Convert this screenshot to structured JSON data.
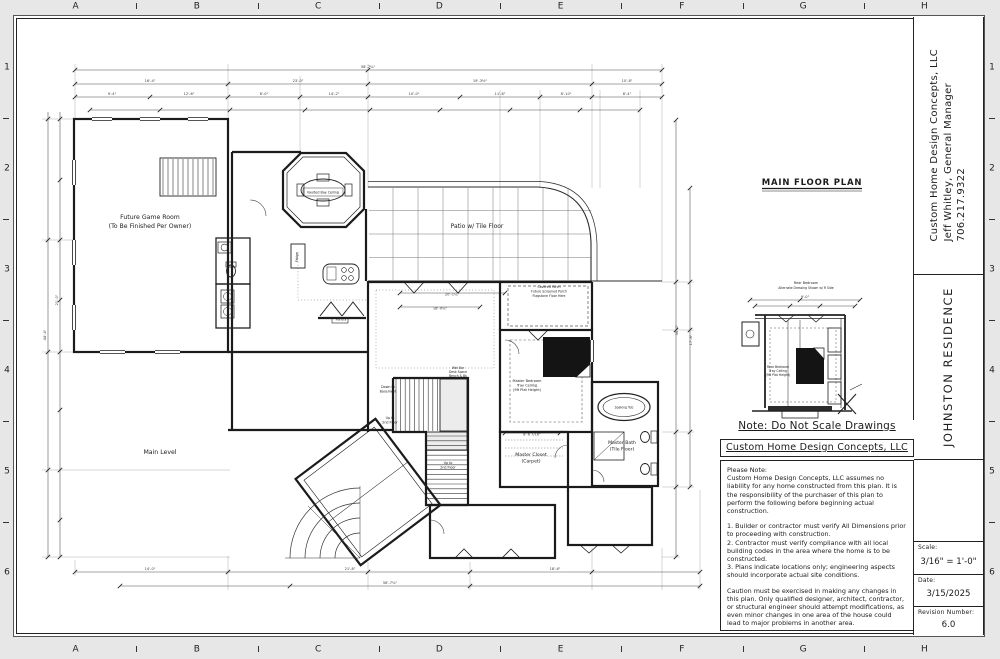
{
  "page": {
    "background": "#e7e7e7",
    "line_color": "#2b2b2b"
  },
  "sheet": {
    "grid_letters": [
      "A",
      "B",
      "C",
      "D",
      "E",
      "F",
      "G",
      "H"
    ],
    "grid_numbers": [
      "1",
      "2",
      "3",
      "4",
      "5",
      "6"
    ]
  },
  "title_block": {
    "company": "Custom Home Design Concepts, LLC",
    "manager": "Jeff Whitley, General Manager",
    "phone": "706.217.9322",
    "project": "JOHNSTON RESIDENCE",
    "scale_label": "Scale:",
    "scale_value": "3/16\" = 1'-0\"",
    "date_label": "Date:",
    "date_value": "3/15/2025",
    "revision_label": "Revision Number:",
    "revision_value": "6.0"
  },
  "notes_panel": {
    "note_header": "Note: Do Not Scale Drawings",
    "company_header": "Custom Home Design Concepts, LLC",
    "paragraphs": [
      {
        "text": "Please Note:",
        "gap": false
      },
      {
        "text": "Custom Home Design Concepts, LLC assumes no liability for any home constructed from this plan. It is the responsibility of the purchaser of this plan to perform the following before beginning actual construction.",
        "gap": false
      },
      {
        "text": "1.  Builder or contractor must verify All Dimensions prior to proceeding with construction.",
        "gap": true
      },
      {
        "text": "2.  Contractor must verify compliance with all local building codes in the area where the home is to be constructed.",
        "gap": false
      },
      {
        "text": "3.  Plans indicate locations only; engineering aspects should incorporate actual site conditions.",
        "gap": false
      },
      {
        "text": "Caution must be exercised in making any changes in this plan.  Only qualified designer, architect, contractor, or structural engineer should attempt modifications, as even minor changes in one area of the house could lead to major problems in another area.",
        "gap": true
      }
    ]
  },
  "plan": {
    "title": "MAIN FLOOR PLAN",
    "labels": [
      {
        "t": "MAIN FLOOR PLAN",
        "x": 812,
        "y": 185,
        "s": 8.5,
        "b": 1,
        "ls": 0.8
      },
      {
        "t": "Future Game Room",
        "x": 150,
        "y": 219,
        "s": 6.2
      },
      {
        "t": "(To Be Finished Per Owner)",
        "x": 150,
        "y": 228,
        "s": 6.2
      },
      {
        "t": "Vaulted Bay Ceiling",
        "x": 323,
        "y": 193.5,
        "s": 3.3
      },
      {
        "t": "Patio w/ Tile Floor",
        "x": 477,
        "y": 228,
        "s": 6
      },
      {
        "t": "Main Level",
        "x": 160,
        "y": 454,
        "s": 6.2
      },
      {
        "t": "Covered Porch",
        "x": 549,
        "y": 288,
        "s": 3.2
      },
      {
        "t": "Future Screened Porch",
        "x": 549,
        "y": 292.5,
        "s": 3.2
      },
      {
        "t": "Flagstone Floor Here",
        "x": 549,
        "y": 297,
        "s": 3.2
      },
      {
        "t": "Master Bedroom",
        "x": 527,
        "y": 382,
        "s": 3.5
      },
      {
        "t": "Tray Ceiling",
        "x": 527,
        "y": 386.5,
        "s": 3.5
      },
      {
        "t": "(9ft Plat Height)",
        "x": 527,
        "y": 391,
        "s": 3.5
      },
      {
        "t": "Master Closet",
        "x": 531,
        "y": 456,
        "s": 4.6
      },
      {
        "t": "(Carpet)",
        "x": 531,
        "y": 462.5,
        "s": 4.6
      },
      {
        "t": "Master Bath",
        "x": 622,
        "y": 444,
        "s": 4.6
      },
      {
        "t": "(Tile Floor)",
        "x": 622,
        "y": 450.5,
        "s": 4.6
      },
      {
        "t": "Down to",
        "x": 388,
        "y": 388,
        "s": 3.3
      },
      {
        "t": "Basement",
        "x": 388,
        "y": 392.5,
        "s": 3.3
      },
      {
        "t": "Up to",
        "x": 390,
        "y": 419,
        "s": 3.3
      },
      {
        "t": "2nd Floor",
        "x": 390,
        "y": 423.5,
        "s": 3.3
      },
      {
        "t": "Up to",
        "x": 448,
        "y": 464,
        "s": 3.3
      },
      {
        "t": "2nd Floor",
        "x": 448,
        "y": 468.5,
        "s": 3.3
      },
      {
        "t": "Fridge",
        "x": 298,
        "y": 257,
        "s": 3.2,
        "r": -90
      },
      {
        "t": "Pantry",
        "x": 341,
        "y": 320.5,
        "s": 3.4
      },
      {
        "t": "Soaking Tub",
        "x": 624,
        "y": 408.5,
        "s": 3.1
      },
      {
        "t": "Wet Bar",
        "x": 458,
        "y": 369,
        "s": 3.1
      },
      {
        "t": "Desk Space",
        "x": 458,
        "y": 373,
        "s": 3.1
      },
      {
        "t": "Bench & Bk",
        "x": 458,
        "y": 377,
        "s": 3.1
      },
      {
        "t": "Rear Bedroom",
        "x": 806,
        "y": 284,
        "s": 3.4
      },
      {
        "t": "Alternate Dressing Shown w/ R Side",
        "x": 806,
        "y": 289,
        "s": 3.1
      },
      {
        "t": "Rear Bedroom",
        "x": 778,
        "y": 368,
        "s": 3.1
      },
      {
        "t": "Tray Ceiling",
        "x": 778,
        "y": 372,
        "s": 3.1
      },
      {
        "t": "(9ft Plat Height)",
        "x": 778,
        "y": 376,
        "s": 3.1
      }
    ],
    "dims": [
      {
        "t": "58'-7¾\"",
        "x": 368,
        "y": 68
      },
      {
        "t": "16'-4\"",
        "x": 150,
        "y": 82
      },
      {
        "t": "23'-0\"",
        "x": 298,
        "y": 82
      },
      {
        "t": "19'-3½\"",
        "x": 480,
        "y": 82
      },
      {
        "t": "10'-8\"",
        "x": 627,
        "y": 82
      },
      {
        "t": "9'-4\"",
        "x": 112,
        "y": 95
      },
      {
        "t": "12'-6\"",
        "x": 189,
        "y": 95
      },
      {
        "t": "8'-0\"",
        "x": 264,
        "y": 95
      },
      {
        "t": "14'-2\"",
        "x": 334,
        "y": 95
      },
      {
        "t": "10'-0\"",
        "x": 414,
        "y": 95
      },
      {
        "t": "11'-6\"",
        "x": 500,
        "y": 95
      },
      {
        "t": "6'-10\"",
        "x": 566,
        "y": 95
      },
      {
        "t": "8'-4\"",
        "x": 627,
        "y": 95
      },
      {
        "t": "44'-4\"",
        "x": 46,
        "y": 335,
        "r": -90
      },
      {
        "t": "21'-0\"",
        "x": 58,
        "y": 300,
        "r": -90
      },
      {
        "t": "36'-0\"",
        "x": 678,
        "y": 330,
        "r": -90
      },
      {
        "t": "17'-8\"",
        "x": 692,
        "y": 340,
        "r": -90
      },
      {
        "t": "20'-1¼\"",
        "x": 452,
        "y": 295.5
      },
      {
        "t": "18'-0¾\"",
        "x": 440,
        "y": 309.5
      },
      {
        "t": "8'-6 7/16\"",
        "x": 532,
        "y": 435.5
      },
      {
        "t": "14'-0\"",
        "x": 150,
        "y": 570
      },
      {
        "t": "21'-8\"",
        "x": 350,
        "y": 570
      },
      {
        "t": "18'-6\"",
        "x": 555,
        "y": 570
      },
      {
        "t": "58'-7¾\"",
        "x": 390,
        "y": 584
      },
      {
        "t": "9'-0\"",
        "x": 805,
        "y": 298
      }
    ]
  }
}
